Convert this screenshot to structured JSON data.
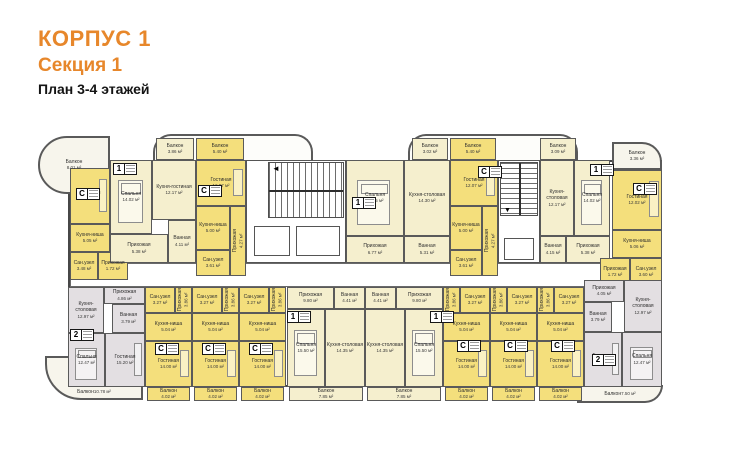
{
  "header": {
    "building": "КОРПУС 1",
    "section": "Секция 1",
    "floors": "План 3-4 этажей"
  },
  "colors": {
    "accent_orange": "#e7872b",
    "studio_fill": "#f4df7c",
    "one_room_fill": "#f5efce",
    "two_room_fill": "#e3dfe2",
    "wall": "#4a4a4a"
  },
  "plan": {
    "rooms": [
      {
        "n": "Балкон",
        "a": "8.01 м²",
        "x": 38,
        "y": 136,
        "w": 72,
        "h": 58,
        "c": "b",
        "r": "tl"
      },
      {
        "n": "Балкон",
        "a": "3.36 м²",
        "x": 612,
        "y": 142,
        "w": 50,
        "h": 28,
        "c": "b",
        "r": "tr"
      },
      {
        "n": "Балкон",
        "a": "10.78 м²",
        "x": 45,
        "y": 356,
        "w": 98,
        "h": 44,
        "c": "b",
        "r": "bl"
      },
      {
        "n": "Балкон",
        "a": "7.50 м²",
        "x": 577,
        "y": 385,
        "w": 86,
        "h": 18,
        "c": "b",
        "r": "br"
      },
      {
        "n": "Гостиная",
        "a": "12.00 м²",
        "x": 70,
        "y": 168,
        "w": 40,
        "h": 56,
        "c": "s",
        "f": "sofa"
      },
      {
        "n": "Кухня-ниша",
        "a": "5.05 м²",
        "x": 70,
        "y": 224,
        "w": 40,
        "h": 28,
        "c": "s"
      },
      {
        "n": "Сан.узел",
        "a": "3.48 м²",
        "x": 70,
        "y": 252,
        "w": 28,
        "h": 28,
        "c": "s"
      },
      {
        "n": "Прихожая",
        "a": "1.72 м²",
        "x": 98,
        "y": 252,
        "w": 30,
        "h": 28,
        "c": "s"
      },
      {
        "n": "Спальня",
        "a": "14.02 м²",
        "x": 110,
        "y": 160,
        "w": 42,
        "h": 74,
        "c": "p",
        "f": "bed"
      },
      {
        "n": "Кухня-гостиная",
        "a": "12.17 м²",
        "x": 152,
        "y": 160,
        "w": 44,
        "h": 60,
        "c": "p"
      },
      {
        "n": "Прихожая",
        "a": "5.38 м²",
        "x": 110,
        "y": 234,
        "w": 58,
        "h": 29,
        "c": "p"
      },
      {
        "n": "Ванная",
        "a": "4.11 м²",
        "x": 168,
        "y": 220,
        "w": 28,
        "h": 43,
        "c": "p"
      },
      {
        "n": "Гостиная",
        "a": "12.07 м²",
        "x": 196,
        "y": 160,
        "w": 50,
        "h": 46,
        "c": "s",
        "f": "sofa"
      },
      {
        "n": "Кухня-ниша",
        "a": "5.00 м²",
        "x": 196,
        "y": 206,
        "w": 34,
        "h": 44,
        "c": "s"
      },
      {
        "n": "Сан.узел",
        "a": "3.61 м²",
        "x": 196,
        "y": 250,
        "w": 34,
        "h": 26,
        "c": "s"
      },
      {
        "n": "Прихожая",
        "a": "4.27 м²",
        "x": 230,
        "y": 206,
        "w": 16,
        "h": 70,
        "c": "s",
        "v": 1
      },
      {
        "n": "Спальня",
        "a": "14.85 м²",
        "x": 346,
        "y": 160,
        "w": 58,
        "h": 76,
        "c": "p",
        "f": "bed"
      },
      {
        "n": "Кухня-столовая",
        "a": "14.30 м²",
        "x": 404,
        "y": 160,
        "w": 46,
        "h": 76,
        "c": "p"
      },
      {
        "n": "Прихожая",
        "a": "6.77 м²",
        "x": 346,
        "y": 236,
        "w": 58,
        "h": 27,
        "c": "p"
      },
      {
        "n": "Ванная",
        "a": "5.31 м²",
        "x": 404,
        "y": 236,
        "w": 46,
        "h": 27,
        "c": "p"
      },
      {
        "n": "Гостиная",
        "a": "12.07 м²",
        "x": 450,
        "y": 160,
        "w": 48,
        "h": 46,
        "c": "s",
        "f": "sofa"
      },
      {
        "n": "Кухня-ниша",
        "a": "5.00 м²",
        "x": 450,
        "y": 206,
        "w": 32,
        "h": 44,
        "c": "s"
      },
      {
        "n": "Сан.узел",
        "a": "3.61 м²",
        "x": 450,
        "y": 250,
        "w": 32,
        "h": 26,
        "c": "s"
      },
      {
        "n": "Прихожая",
        "a": "4.27 м²",
        "x": 482,
        "y": 206,
        "w": 16,
        "h": 70,
        "c": "s",
        "v": 1
      },
      {
        "n": "Кухня-столовая",
        "a": "12.17 м²",
        "x": 540,
        "y": 160,
        "w": 34,
        "h": 76,
        "c": "p"
      },
      {
        "n": "Спальня",
        "a": "14.02 м²",
        "x": 574,
        "y": 160,
        "w": 36,
        "h": 76,
        "c": "p",
        "f": "bed"
      },
      {
        "n": "Ванная",
        "a": "4.15 м²",
        "x": 540,
        "y": 236,
        "w": 26,
        "h": 27,
        "c": "p"
      },
      {
        "n": "Прихожая",
        "a": "5.38 м²",
        "x": 566,
        "y": 236,
        "w": 44,
        "h": 27,
        "c": "p"
      },
      {
        "n": "Гостиная",
        "a": "12.02 м²",
        "x": 612,
        "y": 170,
        "w": 50,
        "h": 60,
        "c": "s",
        "f": "sofa"
      },
      {
        "n": "Кухня-ниша",
        "a": "5.06 м²",
        "x": 612,
        "y": 230,
        "w": 50,
        "h": 28,
        "c": "s"
      },
      {
        "n": "Прихожая",
        "a": "1.72 м²",
        "x": 600,
        "y": 258,
        "w": 30,
        "h": 28,
        "c": "s"
      },
      {
        "n": "Сан.узел",
        "a": "3.60 м²",
        "x": 630,
        "y": 258,
        "w": 32,
        "h": 28,
        "c": "s"
      },
      {
        "n": "Балкон",
        "a": "3.86 м²",
        "x": 156,
        "y": 138,
        "w": 38,
        "h": 22,
        "c": "p"
      },
      {
        "n": "Балкон",
        "a": "5.40 м²",
        "x": 196,
        "y": 138,
        "w": 48,
        "h": 22,
        "c": "s"
      },
      {
        "n": "Балкон",
        "a": "3.02 м²",
        "x": 412,
        "y": 138,
        "w": 36,
        "h": 22,
        "c": "p"
      },
      {
        "n": "Балкон",
        "a": "5.40 м²",
        "x": 450,
        "y": 138,
        "w": 46,
        "h": 22,
        "c": "s"
      },
      {
        "n": "Балкон",
        "a": "3.09 м²",
        "x": 540,
        "y": 138,
        "w": 36,
        "h": 22,
        "c": "p"
      },
      {
        "n": "Кухня-столовая",
        "a": "12.97 м²",
        "x": 68,
        "y": 287,
        "w": 36,
        "h": 46,
        "c": "g"
      },
      {
        "n": "Прихожая",
        "a": "4.86 м²",
        "x": 104,
        "y": 287,
        "w": 41,
        "h": 17,
        "c": "g"
      },
      {
        "n": "Ванная",
        "a": "3.79 м²",
        "x": 112,
        "y": 304,
        "w": 33,
        "h": 29,
        "c": "g"
      },
      {
        "n": "Спальня",
        "a": "12.47 м²",
        "x": 68,
        "y": 333,
        "w": 37,
        "h": 54,
        "c": "g",
        "f": "bed"
      },
      {
        "n": "Гостиная",
        "a": "15.20 м²",
        "x": 105,
        "y": 333,
        "w": 40,
        "h": 54,
        "c": "g",
        "f": "sofa"
      },
      {
        "n": "Сан.узел",
        "a": "3.27 м²",
        "x": 145,
        "y": 287,
        "w": 30,
        "h": 26,
        "c": "s"
      },
      {
        "n": "Прихожая",
        "a": "3.86 м²",
        "x": 175,
        "y": 287,
        "w": 17,
        "h": 26,
        "c": "s",
        "v": 1
      },
      {
        "n": "Кухня-ниша",
        "a": "5.04 м²",
        "x": 145,
        "y": 313,
        "w": 47,
        "h": 28,
        "c": "s"
      },
      {
        "n": "Гостиная",
        "a": "14.00 м²",
        "x": 145,
        "y": 341,
        "w": 47,
        "h": 46,
        "c": "s",
        "f": "sofa"
      },
      {
        "n": "Сан.узел",
        "a": "3.27 м²",
        "x": 192,
        "y": 287,
        "w": 30,
        "h": 26,
        "c": "s"
      },
      {
        "n": "Прихожая",
        "a": "3.86 м²",
        "x": 222,
        "y": 287,
        "w": 17,
        "h": 26,
        "c": "s",
        "v": 1
      },
      {
        "n": "Кухня-ниша",
        "a": "5.04 м²",
        "x": 192,
        "y": 313,
        "w": 47,
        "h": 28,
        "c": "s"
      },
      {
        "n": "Гостиная",
        "a": "14.00 м²",
        "x": 192,
        "y": 341,
        "w": 47,
        "h": 46,
        "c": "s",
        "f": "sofa"
      },
      {
        "n": "Сан.узел",
        "a": "3.27 м²",
        "x": 239,
        "y": 287,
        "w": 30,
        "h": 26,
        "c": "s"
      },
      {
        "n": "Прихожая",
        "a": "3.86 м²",
        "x": 269,
        "y": 287,
        "w": 17,
        "h": 26,
        "c": "s",
        "v": 1
      },
      {
        "n": "Кухня-ниша",
        "a": "5.04 м²",
        "x": 239,
        "y": 313,
        "w": 47,
        "h": 28,
        "c": "s"
      },
      {
        "n": "Гостиная",
        "a": "14.00 м²",
        "x": 239,
        "y": 341,
        "w": 47,
        "h": 46,
        "c": "s",
        "f": "sofa"
      },
      {
        "n": "Прихожая",
        "a": "9.80 м²",
        "x": 287,
        "y": 287,
        "w": 47,
        "h": 22,
        "c": "p"
      },
      {
        "n": "Ванная",
        "a": "4.41 м²",
        "x": 334,
        "y": 287,
        "w": 31,
        "h": 22,
        "c": "p"
      },
      {
        "n": "Спальня",
        "a": "15.50 м²",
        "x": 287,
        "y": 309,
        "w": 38,
        "h": 78,
        "c": "p",
        "f": "bed"
      },
      {
        "n": "Кухня-столовая",
        "a": "14.35 м²",
        "x": 325,
        "y": 309,
        "w": 40,
        "h": 78,
        "c": "p"
      },
      {
        "n": "Ванная",
        "a": "4.41 м²",
        "x": 365,
        "y": 287,
        "w": 31,
        "h": 22,
        "c": "p"
      },
      {
        "n": "Прихожая",
        "a": "9.80 м²",
        "x": 396,
        "y": 287,
        "w": 47,
        "h": 22,
        "c": "p"
      },
      {
        "n": "Кухня-столовая",
        "a": "14.35 м²",
        "x": 365,
        "y": 309,
        "w": 40,
        "h": 78,
        "c": "p"
      },
      {
        "n": "Спальня",
        "a": "15.50 м²",
        "x": 405,
        "y": 309,
        "w": 38,
        "h": 78,
        "c": "p",
        "f": "bed"
      },
      {
        "n": "Прихожая",
        "a": "3.86 м²",
        "x": 443,
        "y": 287,
        "w": 17,
        "h": 26,
        "c": "s",
        "v": 1
      },
      {
        "n": "Сан.узел",
        "a": "3.27 м²",
        "x": 460,
        "y": 287,
        "w": 30,
        "h": 26,
        "c": "s"
      },
      {
        "n": "Кухня-ниша",
        "a": "5.04 м²",
        "x": 443,
        "y": 313,
        "w": 47,
        "h": 28,
        "c": "s"
      },
      {
        "n": "Гостиная",
        "a": "14.00 м²",
        "x": 443,
        "y": 341,
        "w": 47,
        "h": 46,
        "c": "s",
        "f": "sofa"
      },
      {
        "n": "Прихожая",
        "a": "3.86 м²",
        "x": 490,
        "y": 287,
        "w": 17,
        "h": 26,
        "c": "s",
        "v": 1
      },
      {
        "n": "Сан.узел",
        "a": "3.27 м²",
        "x": 507,
        "y": 287,
        "w": 30,
        "h": 26,
        "c": "s"
      },
      {
        "n": "Кухня-ниша",
        "a": "5.04 м²",
        "x": 490,
        "y": 313,
        "w": 47,
        "h": 28,
        "c": "s"
      },
      {
        "n": "Гостиная",
        "a": "14.00 м²",
        "x": 490,
        "y": 341,
        "w": 47,
        "h": 46,
        "c": "s",
        "f": "sofa"
      },
      {
        "n": "Прихожая",
        "a": "3.86 м²",
        "x": 537,
        "y": 287,
        "w": 17,
        "h": 26,
        "c": "s",
        "v": 1
      },
      {
        "n": "Сан.узел",
        "a": "3.27 м²",
        "x": 554,
        "y": 287,
        "w": 30,
        "h": 26,
        "c": "s"
      },
      {
        "n": "Кухня-ниша",
        "a": "5.04 м²",
        "x": 537,
        "y": 313,
        "w": 47,
        "h": 28,
        "c": "s"
      },
      {
        "n": "Гостиная",
        "a": "14.00 м²",
        "x": 537,
        "y": 341,
        "w": 47,
        "h": 46,
        "c": "s",
        "f": "sofa"
      },
      {
        "n": "Прихожая",
        "a": "4.05 м²",
        "x": 584,
        "y": 280,
        "w": 40,
        "h": 22,
        "c": "g"
      },
      {
        "n": "Кухня-столовая",
        "a": "12.97 м²",
        "x": 624,
        "y": 280,
        "w": 38,
        "h": 52,
        "c": "g"
      },
      {
        "n": "Ванная",
        "a": "3.79 м²",
        "x": 584,
        "y": 302,
        "w": 28,
        "h": 30,
        "c": "g"
      },
      {
        "n": "Гостиная",
        "a": "15.20 м²",
        "x": 584,
        "y": 332,
        "w": 38,
        "h": 55,
        "c": "g",
        "f": "sofa"
      },
      {
        "n": "Спальня",
        "a": "12.47 м²",
        "x": 622,
        "y": 332,
        "w": 40,
        "h": 55,
        "c": "g",
        "f": "bed"
      },
      {
        "n": "Балкон",
        "a": "4.02 м²",
        "x": 147,
        "y": 387,
        "w": 43,
        "h": 14,
        "c": "s"
      },
      {
        "n": "Балкон",
        "a": "4.02 м²",
        "x": 194,
        "y": 387,
        "w": 43,
        "h": 14,
        "c": "s"
      },
      {
        "n": "Балкон",
        "a": "4.02 м²",
        "x": 241,
        "y": 387,
        "w": 43,
        "h": 14,
        "c": "s"
      },
      {
        "n": "Балкон",
        "a": "7.85 м²",
        "x": 289,
        "y": 387,
        "w": 74,
        "h": 14,
        "c": "p"
      },
      {
        "n": "Балкон",
        "a": "7.85 м²",
        "x": 367,
        "y": 387,
        "w": 74,
        "h": 14,
        "c": "p"
      },
      {
        "n": "Балкон",
        "a": "4.02 м²",
        "x": 445,
        "y": 387,
        "w": 43,
        "h": 14,
        "c": "s"
      },
      {
        "n": "Балкон",
        "a": "4.02 м²",
        "x": 492,
        "y": 387,
        "w": 43,
        "h": 14,
        "c": "s"
      },
      {
        "n": "Балкон",
        "a": "4.02 м²",
        "x": 539,
        "y": 387,
        "w": 43,
        "h": 14,
        "c": "s"
      }
    ],
    "marks": [
      {
        "t": "С",
        "x": 76,
        "y": 188
      },
      {
        "t": "1",
        "x": 113,
        "y": 163
      },
      {
        "t": "С",
        "x": 198,
        "y": 185
      },
      {
        "t": "1",
        "x": 352,
        "y": 197
      },
      {
        "t": "С",
        "x": 478,
        "y": 166
      },
      {
        "t": "1",
        "x": 590,
        "y": 164
      },
      {
        "t": "С",
        "x": 633,
        "y": 183
      },
      {
        "t": "2",
        "x": 70,
        "y": 329
      },
      {
        "t": "С",
        "x": 155,
        "y": 343
      },
      {
        "t": "С",
        "x": 202,
        "y": 343
      },
      {
        "t": "С",
        "x": 249,
        "y": 343
      },
      {
        "t": "1",
        "x": 287,
        "y": 311
      },
      {
        "t": "1",
        "x": 430,
        "y": 311
      },
      {
        "t": "С",
        "x": 457,
        "y": 340
      },
      {
        "t": "С",
        "x": 504,
        "y": 340
      },
      {
        "t": "С",
        "x": 551,
        "y": 340
      },
      {
        "t": "2",
        "x": 592,
        "y": 354
      }
    ]
  }
}
